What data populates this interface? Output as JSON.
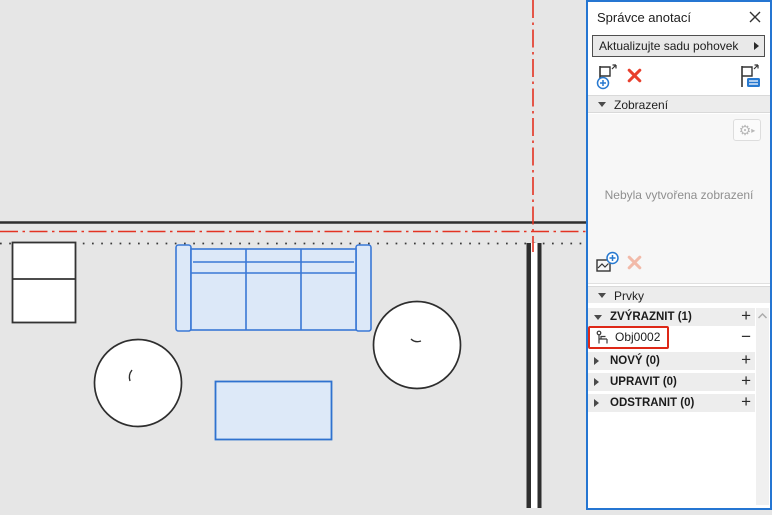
{
  "panel": {
    "title": "Správce anotací",
    "update_button_label": "Aktualizujte sadu pohovek",
    "views_section": {
      "header": "Zobrazení",
      "empty_message": "Nebyla vytvořena zobrazení",
      "gear_glyph": "⚙",
      "gear_arrow": "▸"
    },
    "elements_section": {
      "header": "Prvky",
      "groups": [
        {
          "label": "ZVÝRAZNIT (1)",
          "action": "+"
        },
        {
          "label": "NOVÝ (0)",
          "action": "+"
        },
        {
          "label": "UPRAVIT (0)",
          "action": "+"
        },
        {
          "label": "ODSTRANIT (0)",
          "action": "+"
        }
      ],
      "highlight_item": {
        "label": "Obj0002",
        "action": "−"
      }
    }
  },
  "colors": {
    "panel_border_blue": "#2576d2",
    "selection_red": "#de2817",
    "reference_red": "#e33322",
    "element_blue_stroke": "#3a78d6",
    "element_blue_fill": "#dce8f8",
    "canvas_gray": "#e6e6e6"
  }
}
